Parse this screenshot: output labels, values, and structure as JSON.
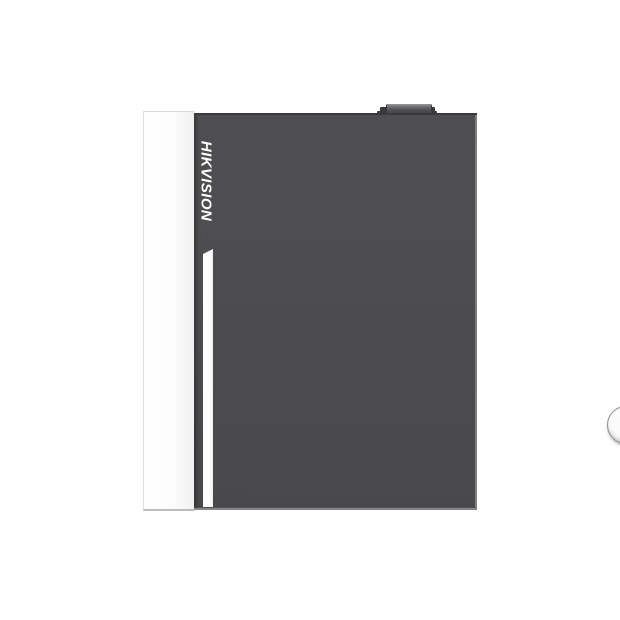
{
  "product": {
    "brand": "HIKVISION",
    "description": "Front view of a wall-mount metal access-controller enclosure on a white background",
    "visible_elements": {
      "logo": "vertical brand text on door, rotated 90 degrees clockwise, white italic",
      "stripe": "white vertical accent stripe below logo with slanted top edge",
      "lock": "round metallic key lock with vertical keyhole on right side of door",
      "top_knob": "small dark knob/tab protruding from top edge",
      "side_panel": "white left side face of the cabinet"
    },
    "colors": {
      "background": "#ffffff",
      "door_gray": "#4c4c4e",
      "door_top_edge": "#3a3a3c",
      "door_right_bevel": "#7e7e81",
      "side_panel": "#fbfbfb",
      "brand_text": "#ffffff",
      "stripe": "#ffffff",
      "lock_face": "#f2f2f2",
      "lock_rim": "#8f8f92",
      "keyhole_outline": "#b4b4b6",
      "knob": "#4e4e50"
    }
  }
}
